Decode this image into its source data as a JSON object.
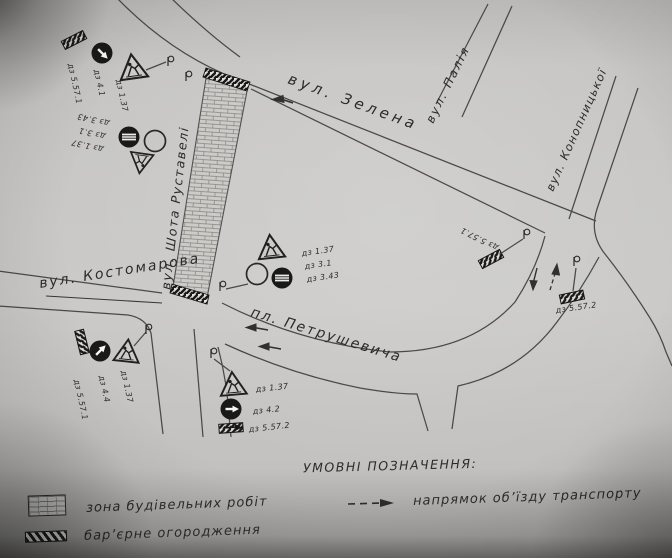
{
  "scheme": {
    "streets": {
      "zelena": "вул. Зелена",
      "palia": "вул. Палія",
      "konopnytska": "вул. Конопницької",
      "kostomarova": "вул. Костомарова",
      "rustaveli": "вул. Шота Руставелі",
      "petrushevycha": "пл. Петрушевича"
    },
    "signs": {
      "top_left": {
        "labels": [
          "дз 5.57.1",
          "дз 4.1",
          "дз 1.37"
        ]
      },
      "left_mid": {
        "labels": [
          "дз 3.43",
          "дз 3.1",
          "дз 1.37"
        ]
      },
      "center": {
        "labels": [
          "дз 1.37",
          "дз 3.1",
          "дз 3.43"
        ]
      },
      "bottom_left": {
        "labels": [
          "дз 1.37",
          "дз 4.4",
          "дз 5.57.1"
        ]
      },
      "bottom_center": {
        "labels": [
          "дз 1.37",
          "дз 4.2",
          "дз 5.57.2"
        ]
      },
      "right_upper": {
        "labels": [
          "дз 5.57.1"
        ]
      },
      "right_lower": {
        "labels": [
          "дз 5.57.2"
        ]
      }
    },
    "legend": {
      "title": "УМОВНІ ПОЗНАЧЕННЯ:",
      "zone": "зона будівельних робіт",
      "barrier": "бар’єрне огородження",
      "detour": "напрямок об’їзду транспорту"
    },
    "colors": {
      "paper": "#c6c5c3",
      "ink": "#3b3b39"
    }
  }
}
